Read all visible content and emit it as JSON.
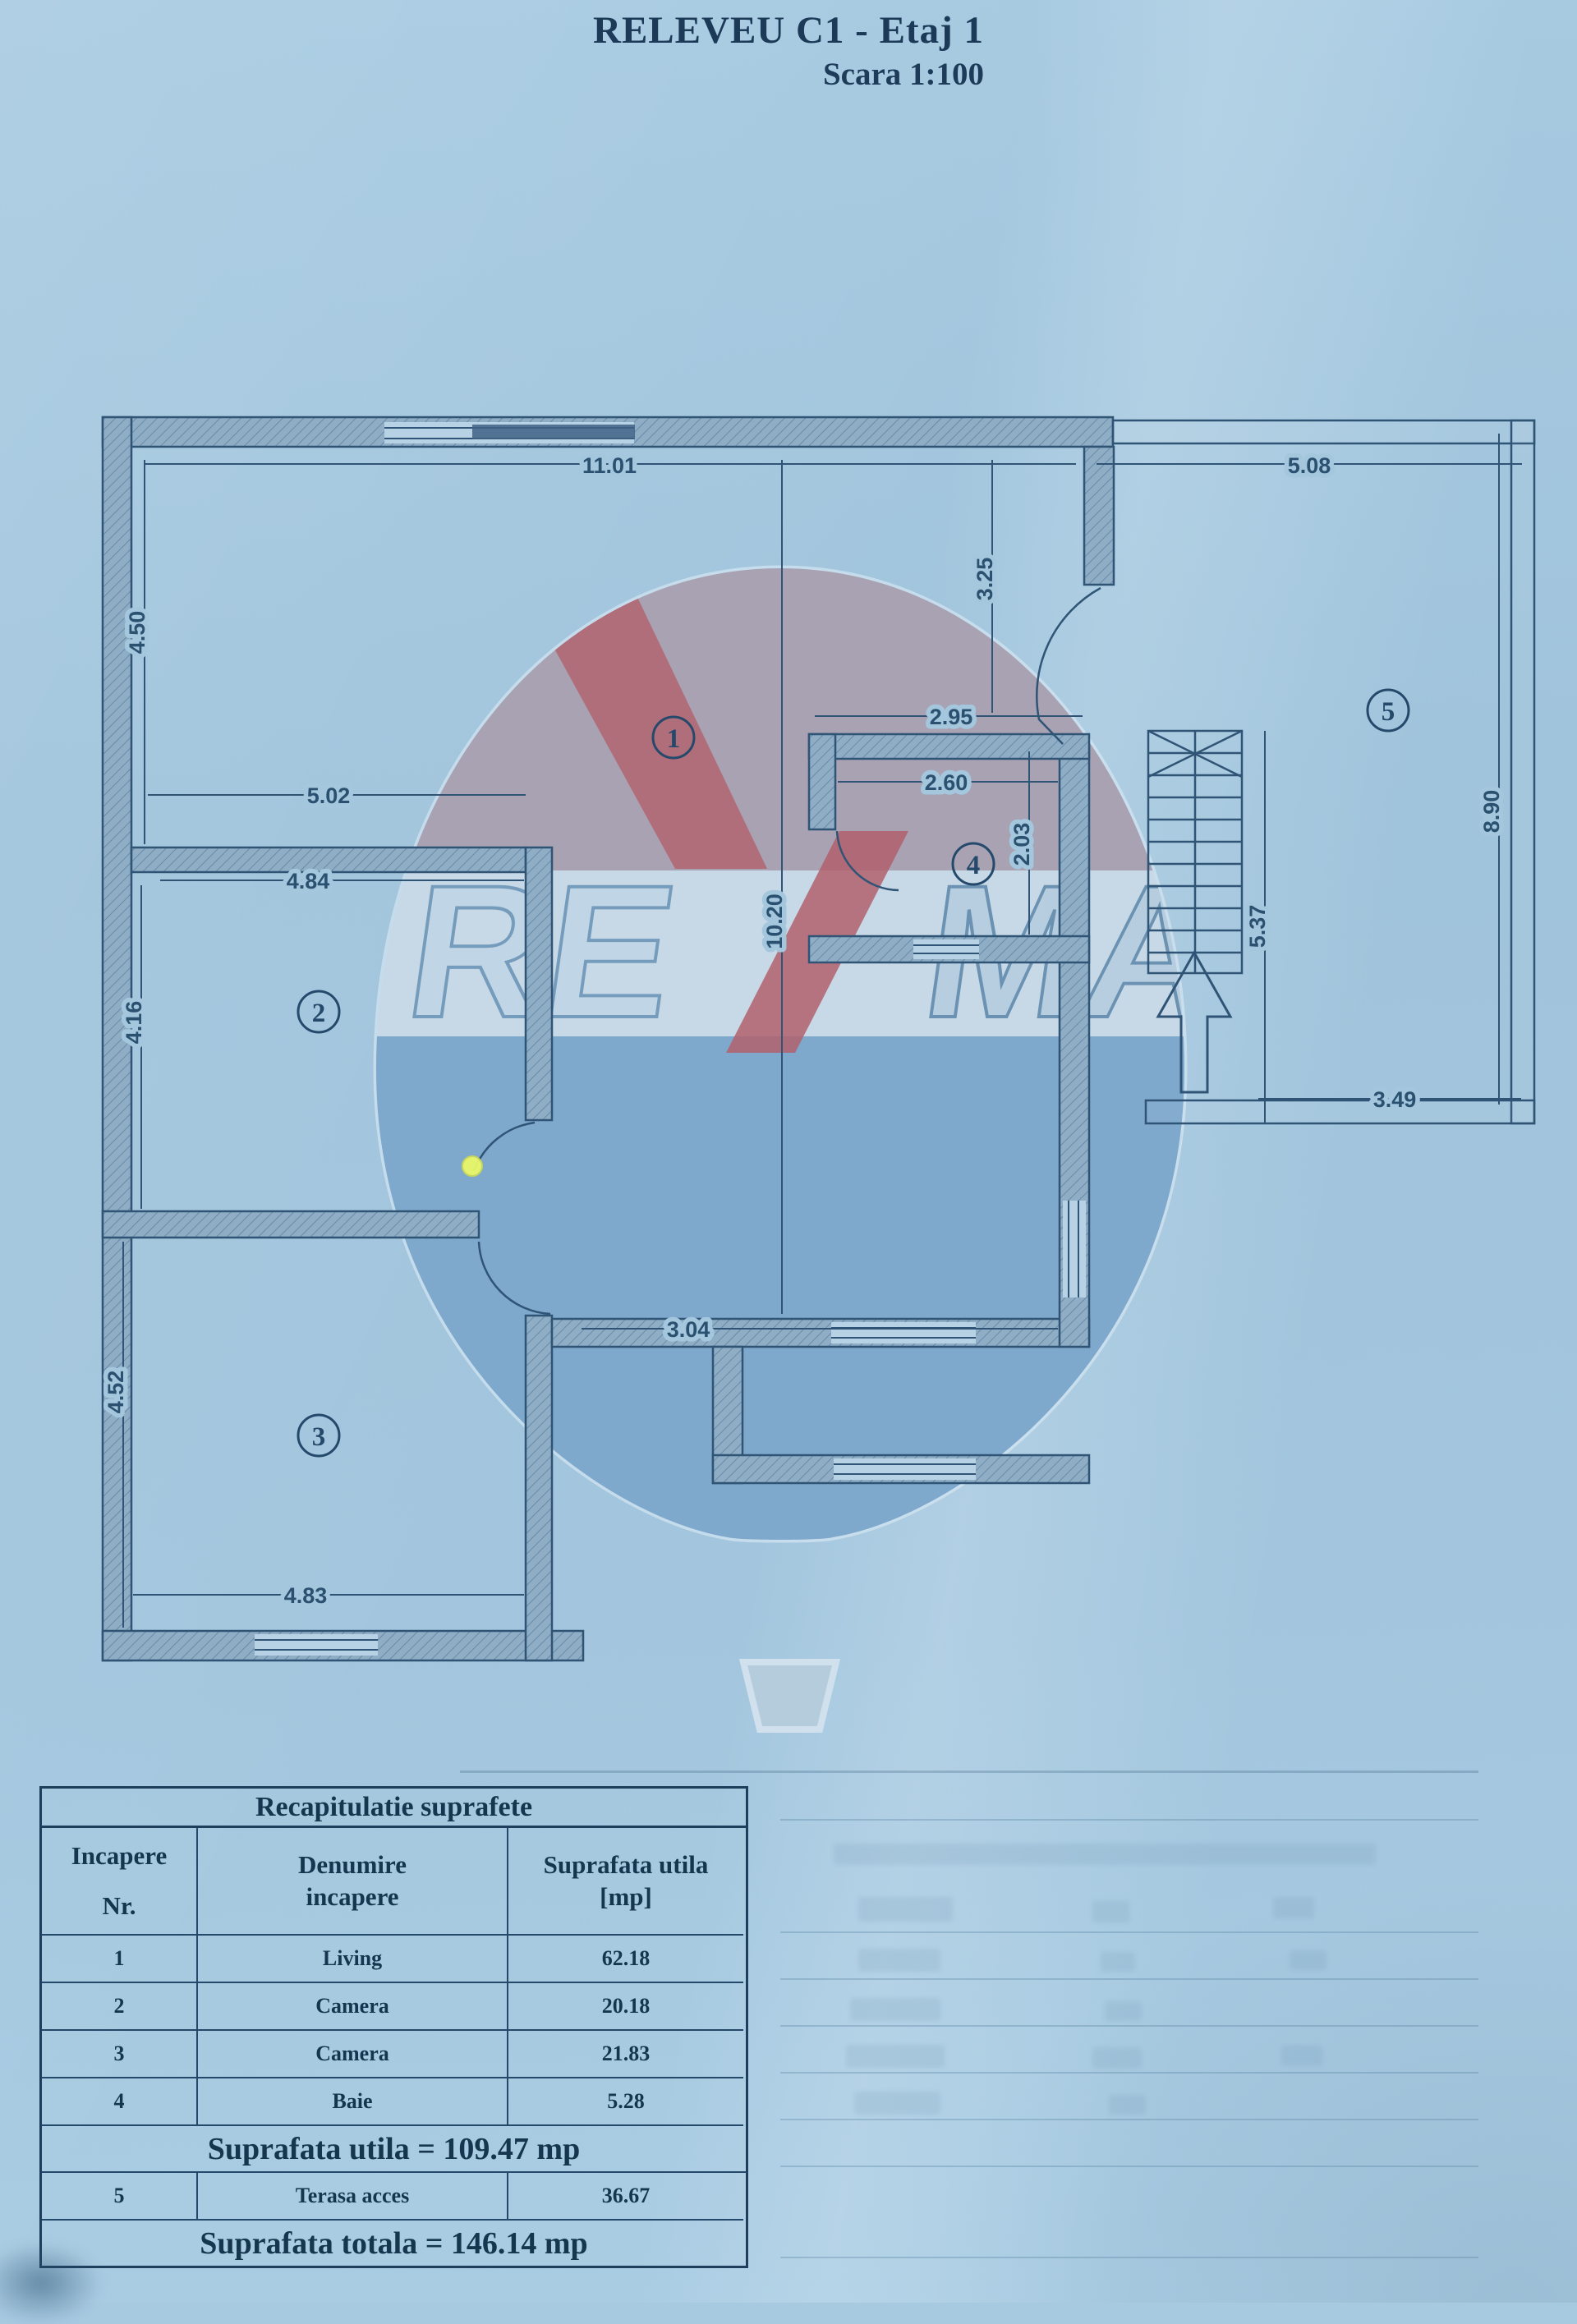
{
  "title": "RELEVEU C1 - Etaj 1",
  "subtitle": "Scara 1:100",
  "colors": {
    "paper": "#a5c8df",
    "ink": "#1c3a58",
    "plan_line": "#2f5475",
    "balloon_top": "#a8a2b3",
    "balloon_band": "#c7d9e7",
    "balloon_bottom": "#7ea8cc",
    "balloon_red": "#b2606c",
    "marker_dot": "#e9f86a"
  },
  "plan": {
    "rooms": [
      {
        "num": "1"
      },
      {
        "num": "2"
      },
      {
        "num": "3"
      },
      {
        "num": "4"
      },
      {
        "num": "5"
      }
    ],
    "dims": [
      {
        "t": "11.01"
      },
      {
        "t": "5.08"
      },
      {
        "t": "4.50"
      },
      {
        "t": "5.02"
      },
      {
        "t": "4.84"
      },
      {
        "t": "4.16"
      },
      {
        "t": "2.95"
      },
      {
        "t": "2.60"
      },
      {
        "t": "3.25"
      },
      {
        "t": "2.03"
      },
      {
        "t": "10.20"
      },
      {
        "t": "3.04"
      },
      {
        "t": "5.37"
      },
      {
        "t": "8.90"
      },
      {
        "t": "3.49"
      },
      {
        "t": "4.52"
      },
      {
        "t": "4.83"
      }
    ]
  },
  "watermark": {
    "re": "RE",
    "max": "MAX"
  },
  "table": {
    "title": "Recapitulatie suprafete",
    "header": {
      "col1_line1": "Incapere",
      "col1_line2": "Nr.",
      "col2_line1": "Denumire",
      "col2_line2": "incapere",
      "col3_line1": "Suprafata utila",
      "col3_line2": "[mp]"
    },
    "rows": [
      {
        "nr": "1",
        "name": "Living",
        "area": "62.18"
      },
      {
        "nr": "2",
        "name": "Camera",
        "area": "20.18"
      },
      {
        "nr": "3",
        "name": "Camera",
        "area": "21.83"
      },
      {
        "nr": "4",
        "name": "Baie",
        "area": "5.28"
      }
    ],
    "subtotal": "Suprafata utila = 109.47 mp",
    "terasa_row": {
      "nr": "5",
      "name": "Terasa acces",
      "area": "36.67"
    },
    "total": "Suprafata totala = 146.14 mp"
  }
}
